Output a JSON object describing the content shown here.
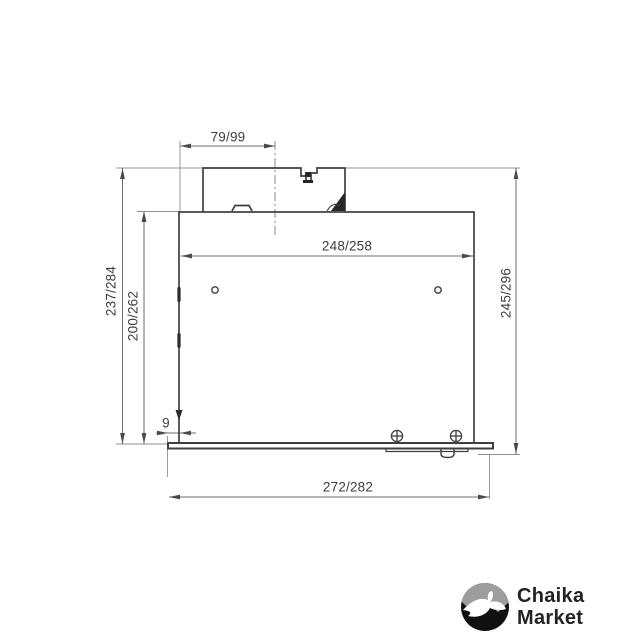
{
  "canvas": {
    "width": 640,
    "height": 640,
    "background": "#ffffff"
  },
  "drawing": {
    "kind": "technical dimension drawing, side section of built-in hood",
    "units": "mm",
    "labels": {
      "top_duct_width": "79/99",
      "inner_body_width": "248/258",
      "left_outer_height": "237/284",
      "left_inner_height": "200/262",
      "right_overall_height": "245/296",
      "bottom_left_offset": "9",
      "bottom_overall_width": "272/282"
    },
    "colors": {
      "object_line": "#3f3f3f",
      "dimension_line": "#6f6f6f",
      "extension_line": "#909090",
      "label_text": "#3e3e3e"
    }
  },
  "logo": {
    "line1": "Chaika",
    "line2": "Market",
    "icon": "seagull-circle-icon",
    "colors": {
      "text": "#232323",
      "circle": "#101010",
      "sky": "#9d9d9d",
      "bird": "#ffffff"
    }
  }
}
